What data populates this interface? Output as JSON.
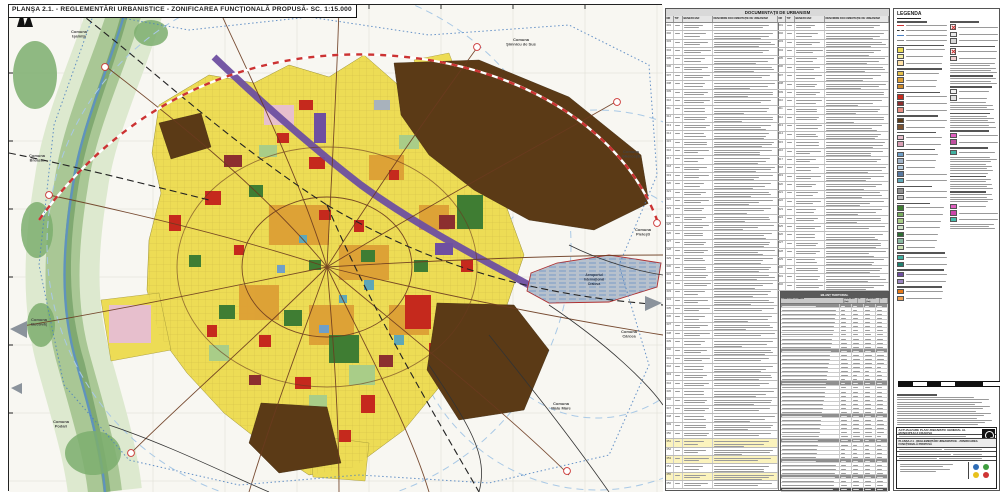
{
  "map": {
    "plate_title": "PLANŞA 2.1. - REGLEMENTĂRI URBANISTICE - ZONIFICAREA FUNCŢIONALĂ PROPUSĂ- SC. 1:15.000",
    "airport_label": [
      "Aeroportul",
      "Internaţional",
      "Craiova"
    ],
    "communes": [
      "Comuna Işalniţa",
      "Comuna Şimnicu de Sus",
      "Comuna Gherceşti",
      "Comuna Pieleşti",
      "Comuna Cârcea",
      "Comuna Malu Mare",
      "Comuna Podari",
      "Comuna Bucovăţ",
      "Comuna Breasta"
    ]
  },
  "docs": {
    "title": "DOCUMENTAŢII DE URBANISM",
    "cols": [
      "NR",
      "TIP",
      "BENEFICIAR",
      "DENUMIRE DOCUMENTAŢIE DE URBANISM"
    ],
    "left_rows": 56,
    "right_rows": 32,
    "highlight_left_rows": [
      50,
      52,
      54
    ]
  },
  "bilant": {
    "title": "BILANŢ TERITORIAL",
    "cols": [
      "ZONA FUNCŢIONALĂ",
      "EXISTENT (ha)",
      "%",
      "PROPUS (ha)",
      "%"
    ],
    "rows": 46,
    "dark_rows": [
      0,
      11,
      19,
      27,
      33,
      38,
      42
    ],
    "darker_rows": [
      45
    ]
  },
  "legend": {
    "title": "LEGENDA",
    "col1": [
      {
        "t": "h"
      },
      {
        "t": "ln",
        "c": "#cc3333"
      },
      {
        "t": "ln",
        "c": "#333333"
      },
      {
        "t": "ln",
        "c": "#4a7fc0"
      },
      {
        "t": "ln",
        "c": "#888888"
      },
      {
        "t": "h"
      },
      {
        "t": "s",
        "c": "#eddc55"
      },
      {
        "t": "s",
        "c": "#f6efa3"
      },
      {
        "t": "s",
        "c": "#ffe2a8"
      },
      {
        "t": "h"
      },
      {
        "t": "s",
        "c": "#e5c04a"
      },
      {
        "t": "s",
        "c": "#dd9f35"
      },
      {
        "t": "s",
        "c": "#cf8a2a"
      },
      {
        "t": "h"
      },
      {
        "t": "s",
        "c": "#c5291d"
      },
      {
        "t": "s",
        "c": "#8c2f2f"
      },
      {
        "t": "s",
        "c": "#e58b80"
      },
      {
        "t": "h"
      },
      {
        "t": "s",
        "c": "#5b3a16"
      },
      {
        "t": "s",
        "c": "#7a5230"
      },
      {
        "t": "h"
      },
      {
        "t": "s",
        "c": "#e7bfcd"
      },
      {
        "t": "s",
        "c": "#d9a0b5"
      },
      {
        "t": "h"
      },
      {
        "t": "s",
        "c": "#6f9fc8"
      },
      {
        "t": "s",
        "c": "#9fb3c8"
      },
      {
        "t": "s",
        "c": "#b8cfe0"
      },
      {
        "t": "s",
        "c": "#5878a0"
      },
      {
        "t": "s",
        "c": "#5ea7b8"
      },
      {
        "t": "h"
      },
      {
        "t": "s",
        "c": "#8f8f8f"
      },
      {
        "t": "s",
        "c": "#b5b5b5"
      },
      {
        "t": "h"
      },
      {
        "t": "s",
        "c": "#3f7d33"
      },
      {
        "t": "s",
        "c": "#79ad5f"
      },
      {
        "t": "s",
        "c": "#a9cd88"
      },
      {
        "t": "s",
        "c": "#cfe3c7"
      },
      {
        "t": "s",
        "c": "#2f6e34"
      },
      {
        "t": "s",
        "c": "#88b8a0"
      },
      {
        "t": "s",
        "c": "#c8e0b0"
      },
      {
        "t": "h"
      },
      {
        "t": "s",
        "c": "#40b0a0"
      },
      {
        "t": "s",
        "c": "#208070"
      },
      {
        "t": "h"
      },
      {
        "t": "s",
        "c": "#6e4fa0"
      },
      {
        "t": "s",
        "c": "#9b85c0"
      },
      {
        "t": "h"
      },
      {
        "t": "s",
        "c": "#e77817"
      },
      {
        "t": "s",
        "c": "#f0a050"
      }
    ],
    "col2": [
      {
        "t": "h"
      },
      {
        "t": "x"
      },
      {
        "t": "s",
        "c": "#e8e8e8"
      },
      {
        "t": "s",
        "c": "#d6d6d6"
      },
      {
        "t": "h"
      },
      {
        "t": "x"
      },
      {
        "t": "s",
        "c": "#f0d0d0"
      },
      {
        "t": "p",
        "n": 5
      },
      {
        "t": "h"
      },
      {
        "t": "p",
        "n": 3
      },
      {
        "t": "h"
      },
      {
        "t": "s",
        "c": "#f2f2f2"
      },
      {
        "t": "s",
        "c": "#e0e0e0"
      },
      {
        "t": "p",
        "n": 4
      },
      {
        "t": "h"
      },
      {
        "t": "p",
        "n": 6
      },
      {
        "t": "h"
      },
      {
        "t": "s",
        "c": "#e060c0"
      },
      {
        "t": "s",
        "c": "#c050a0"
      },
      {
        "t": "h"
      },
      {
        "t": "s",
        "c": "#40b0a0"
      },
      {
        "t": "p",
        "n": 8
      },
      {
        "t": "h"
      },
      {
        "t": "p",
        "n": 5
      },
      {
        "t": "h"
      },
      {
        "t": "p",
        "n": 4
      },
      {
        "t": "s",
        "c": "#e060c0"
      },
      {
        "t": "s",
        "c": "#cc44aa"
      },
      {
        "t": "s",
        "c": "#44bbaa"
      },
      {
        "t": "p",
        "n": 3
      }
    ],
    "scalebar_segments": [
      14,
      14,
      14,
      14,
      28,
      28
    ],
    "notes_lines": 13
  },
  "titleblock": {
    "org_line": "ACTUALIZARE PLAN URBANISTIC GENERAL AL MUNICIPIULUI CRAIOVA",
    "plansa_line": "PLANŞA 2.1 - REGLEMENTĂRI URBANISTICE - ZONIFICAREA FUNCŢIONALĂ PROPUSĂ",
    "logo_dot_colors": [
      "#2f6cb5",
      "#3f9e3f",
      "#e8c11c",
      "#cf3434"
    ]
  },
  "palette": {
    "urban_yellow": "#eddc55",
    "industrial_brown": "#5b3a16",
    "central_red": "#c5291d",
    "rail_purple": "#6e4fa0",
    "green_space": "#3f7d33",
    "water_blue": "#5f93bd",
    "airport_gray": "#b7c1cd",
    "admin_boundary_blue": "#4a7fc0",
    "ring_road_red": "#cc3333"
  }
}
